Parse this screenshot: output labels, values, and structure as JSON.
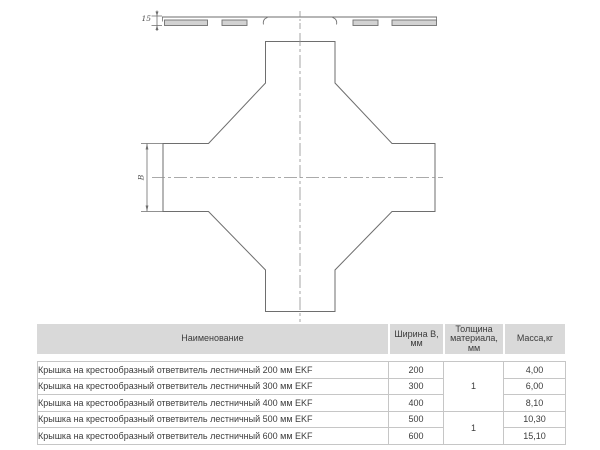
{
  "drawing": {
    "dim_15_label": "15",
    "dim_b_label": "В"
  },
  "table": {
    "headers": {
      "name": "Наименование",
      "width_line1": "Ширина В,",
      "width_line2": "мм",
      "thickness_line1": "Толщина",
      "thickness_line2": "материала,",
      "thickness_line3": "мм",
      "mass": "Масса,кг"
    },
    "rows": [
      {
        "name": "Крышка на крестообразный ответвитель лестничный 200 мм EKF",
        "width": "200",
        "mass": "4,00"
      },
      {
        "name": "Крышка на крестообразный ответвитель лестничный 300 мм EKF",
        "width": "300",
        "mass": "6,00"
      },
      {
        "name": "Крышка на крестообразный ответвитель лестничный 400 мм EKF",
        "width": "400",
        "mass": "8,10"
      },
      {
        "name": "Крышка на крестообразный ответвитель лестничный 500 мм EKF",
        "width": "500",
        "mass": "10,30"
      },
      {
        "name": "Крышка на крестообразный ответвитель лестничный 600 мм EKF",
        "width": "600",
        "mass": "15,10"
      }
    ],
    "thickness_groups": [
      {
        "value": "1"
      },
      {
        "value": "1"
      }
    ]
  },
  "colors": {
    "header_bg": "#d9d9d9",
    "table_border": "#c6c6c6",
    "drawing_line": "#6e6e6e",
    "centerline": "#8f8f8f",
    "text": "#3c3c3c"
  }
}
